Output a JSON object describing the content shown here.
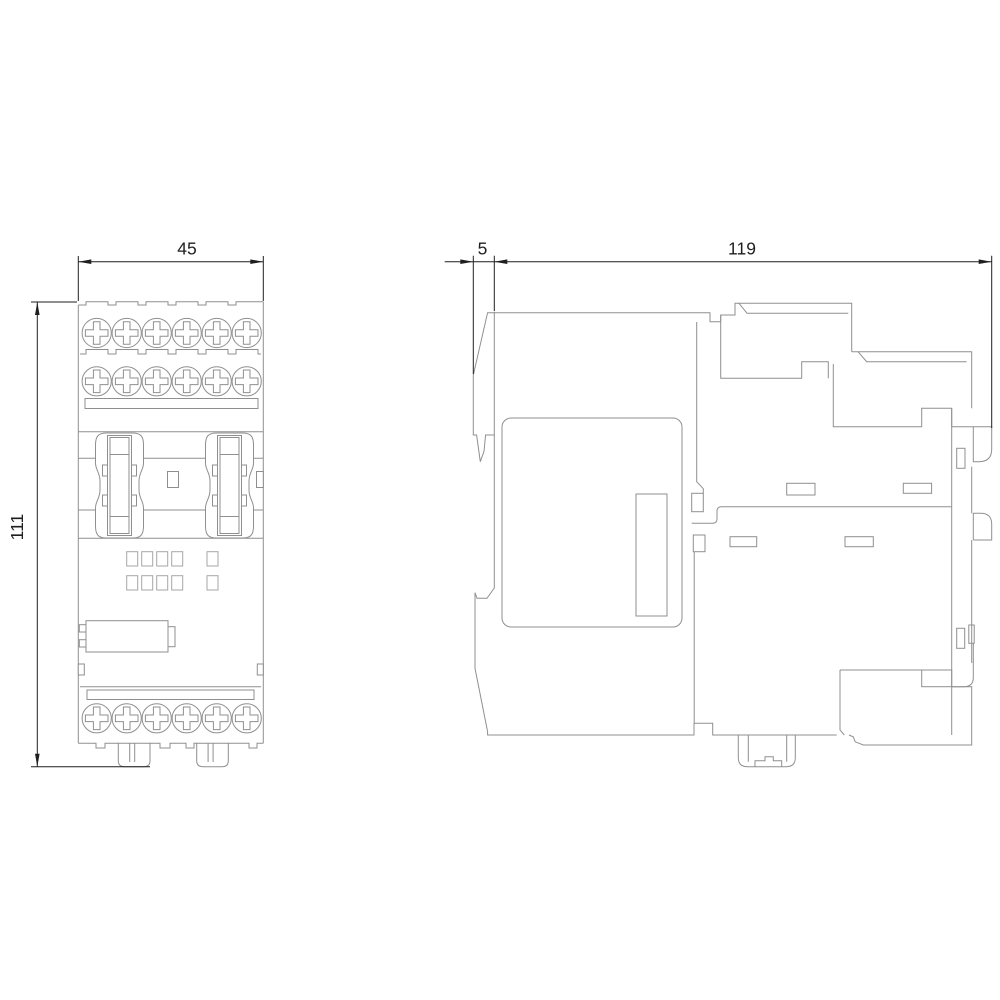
{
  "page": {
    "kind": "technical-dimension-drawing",
    "background": "#ffffff",
    "views": {
      "front": "front-view",
      "side": "side-view"
    }
  },
  "dimensions": {
    "front_width": {
      "value": "45"
    },
    "front_height": {
      "value": "111"
    },
    "side_front_offset": {
      "value": "5"
    },
    "side_depth": {
      "value": "119"
    }
  },
  "colors": {
    "outline": "#8f8f8f",
    "detail": "#a6a6a6",
    "dimension": "#1f1f1f"
  }
}
